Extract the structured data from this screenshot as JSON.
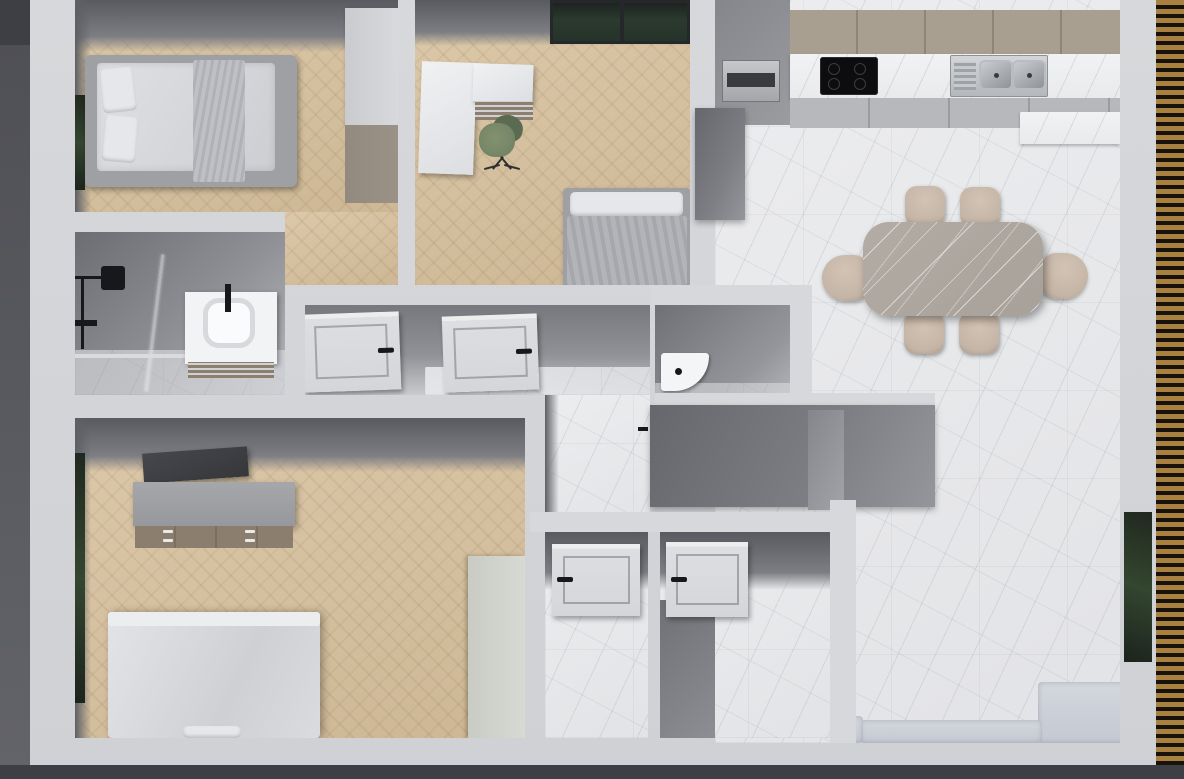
{
  "scene": {
    "kind": "3d-floor-plan-render",
    "view": "top-down-dollhouse",
    "width_px": 1184,
    "height_px": 779
  },
  "palette": {
    "ground": "#56575c",
    "ground-dark": "#3e3f44",
    "slat-wood": "#a9813f",
    "slat-gap": "#17120c",
    "wall-top": "#d6d8db",
    "wall-face": "#7d7e83",
    "bath-wall": "#6c6d72",
    "wood-light": "#dcc9a9",
    "wood-dark": "#cdb795",
    "marble-light": "#ecedef",
    "marble-mid": "#e2e3e6",
    "cabinet-upper": "#a89f90",
    "cabinet-base": "#b6b8bc",
    "counter": "#e9eaec",
    "cooktop": "#0d0d10",
    "steel": "#b4b7bb",
    "oven": "#a3a5a9",
    "table-stone": "#a7a199",
    "chair-beige": "#c5b5a6",
    "chair-green": "#6e7f63",
    "chair-green-dark": "#5a6b52",
    "sofa": "#c4c9d2",
    "duvet": "#dfe0e3",
    "blanket": "#bfc0c5",
    "pillow": "#e6e7ea",
    "bed-frame": "#9fa0a4",
    "door": "#dcdee1",
    "handle": "#17181b",
    "drawer-wood": "#8d7f6d",
    "dresser-front": "#8c7e6e",
    "dresser-top": "#97989c",
    "tv": "#36373b",
    "wardrobe-light": "#d7d9dc",
    "wardrobe-taupe": "#9b9287",
    "wardrobe-green": "#d7d9d3",
    "glass-dark": "#2b3a2e"
  },
  "exterior": {
    "left": "concrete-ground",
    "bottom": "concrete-ground",
    "right": "wood-slat-deck"
  },
  "rooms": [
    {
      "id": "bedroom-1",
      "floor": "wood-herringbone",
      "furniture": [
        "single-bed",
        "wardrobe",
        "window-west"
      ]
    },
    {
      "id": "office-bedroom",
      "floor": "wood-herringbone",
      "furniture": [
        "l-desk",
        "drawer-shelf",
        "green-office-chair",
        "single-bed",
        "window-north"
      ]
    },
    {
      "id": "kitchen-living-room",
      "floor": "marble-tile",
      "furniture": [
        "tall-unit-with-oven",
        "upper-cabinets",
        "countertop",
        "induction-cooktop",
        "double-sink",
        "base-cabinets",
        "dining-table",
        "dining-chairs-x6",
        "sectional-sofa",
        "window-east"
      ]
    },
    {
      "id": "bathroom",
      "floor": "marble-tile",
      "furniture": [
        "rain-shower",
        "glass-partition",
        "towel-bar",
        "vanity-with-basin"
      ]
    },
    {
      "id": "hallway",
      "floor": "marble-tile",
      "furniture": [
        "door-leaf",
        "door-leaf"
      ]
    },
    {
      "id": "wc",
      "floor": "marble-tile",
      "furniture": [
        "corner-sink"
      ]
    },
    {
      "id": "corridor",
      "floor": "marble-tile",
      "furniture": []
    },
    {
      "id": "master-bedroom",
      "floor": "wood-herringbone",
      "furniture": [
        "double-bed",
        "bench",
        "dresser",
        "tv-panel",
        "wardrobe",
        "window-west"
      ]
    },
    {
      "id": "storage-room-a",
      "floor": "marble-tile",
      "furniture": [
        "door-leaf"
      ]
    },
    {
      "id": "storage-room-b",
      "floor": "marble-tile",
      "furniture": [
        "door-leaf"
      ]
    }
  ]
}
